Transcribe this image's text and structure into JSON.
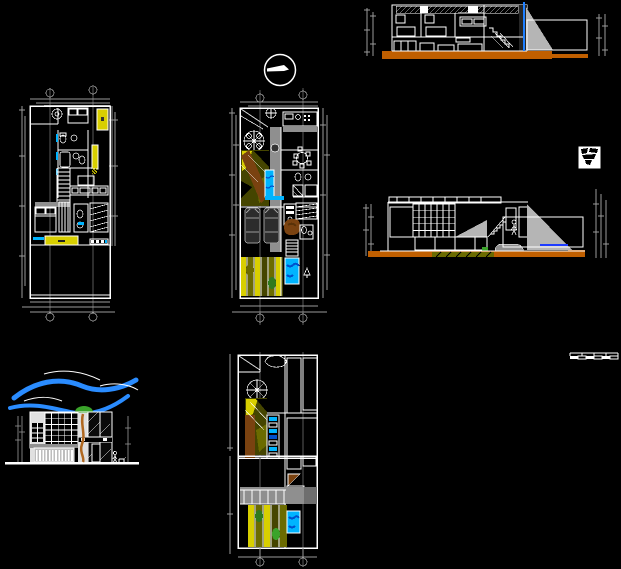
{
  "canvas": {
    "width": 621,
    "height": 569,
    "background": "#000000",
    "description": "CAD model-space sheet of a narrow townhouse: floor plans, sections, elevation, roof plans"
  },
  "palette": {
    "line_white": "#ffffff",
    "dim_gray": "#9a9a9a",
    "axis_gray": "#5a5a5a",
    "yellow": "#d8cf00",
    "olive": "#6b6b00",
    "dark_olive": "#454500",
    "cyan": "#00b4ff",
    "deep_blue": "#0050cc",
    "sky_blue": "#2a8cff",
    "orange": "#c05f00",
    "brown": "#7a4210",
    "trunk_brown": "#b06820",
    "green": "#3aa32a",
    "dark_green": "#2f7a1e",
    "light_gray": "#b5b5b5",
    "mid_gray": "#8f8f8f",
    "panel_white": "#e0e0e0"
  },
  "drawings": {
    "north_arrow": {
      "name": "north-arrow",
      "kind": "symbol"
    },
    "transverse_section": {
      "name": "transverse-section",
      "kind": "section",
      "features": [
        "roof hatch band",
        "two bedrooms",
        "stair",
        "kitchen units",
        "orange ground band",
        "gray ramp wedge",
        "blue section line"
      ]
    },
    "longitudinal_section": {
      "name": "longitudinal-section",
      "kind": "section",
      "features": [
        "gridded curtain wall",
        "diagonal-hatch railing",
        "stair",
        "two human figures",
        "car",
        "gray ramp wedge",
        "blue level line",
        "orange ground band with soil patch"
      ]
    },
    "upper_floor_plan": {
      "name": "upper-floor-plan-left",
      "kind": "plan",
      "features": [
        "laundry",
        "two baths",
        "yellow closets",
        "stairs",
        "living",
        "bedroom",
        "yellow counter",
        "cyan sills",
        "rear patio",
        "2 axis bubbles top and bottom"
      ]
    },
    "ground_floor_plan": {
      "name": "ground-floor-plan-center",
      "kind": "plan",
      "features": [
        "entry with tree rosette",
        "kitchen",
        "dining",
        "ramp garden (olive/brown)",
        "cyan pool",
        "two cars",
        "brown tree",
        "striped rear garden",
        "rear pool",
        "axis bubbles"
      ]
    },
    "front_elevation": {
      "name": "front-elevation",
      "kind": "elevation",
      "features": [
        "blue wind ribbons",
        "green tree with brown trunk",
        "window grid",
        "hatched glazing",
        "garage slats",
        "figures",
        "ground line"
      ]
    },
    "third_level_plan": {
      "name": "third-level-plan",
      "kind": "plan",
      "features": [
        "cloud sketch",
        "fan rosette",
        "olive ramp with brown beam",
        "bar counter with cyan accents",
        "tile-hatch roof strips"
      ]
    },
    "roof_terrace_plan": {
      "name": "roof-terrace-plan",
      "kind": "plan",
      "features": [
        "tile strips",
        "brown wedge",
        "ladder bridge",
        "gray terrace",
        "striped planters",
        "blue pond",
        "axis bubbles"
      ]
    },
    "sheet_logo": {
      "name": "sheet-logo",
      "kind": "logo"
    },
    "scale_bar": {
      "name": "graphic-scale-bar",
      "kind": "symbol"
    }
  }
}
